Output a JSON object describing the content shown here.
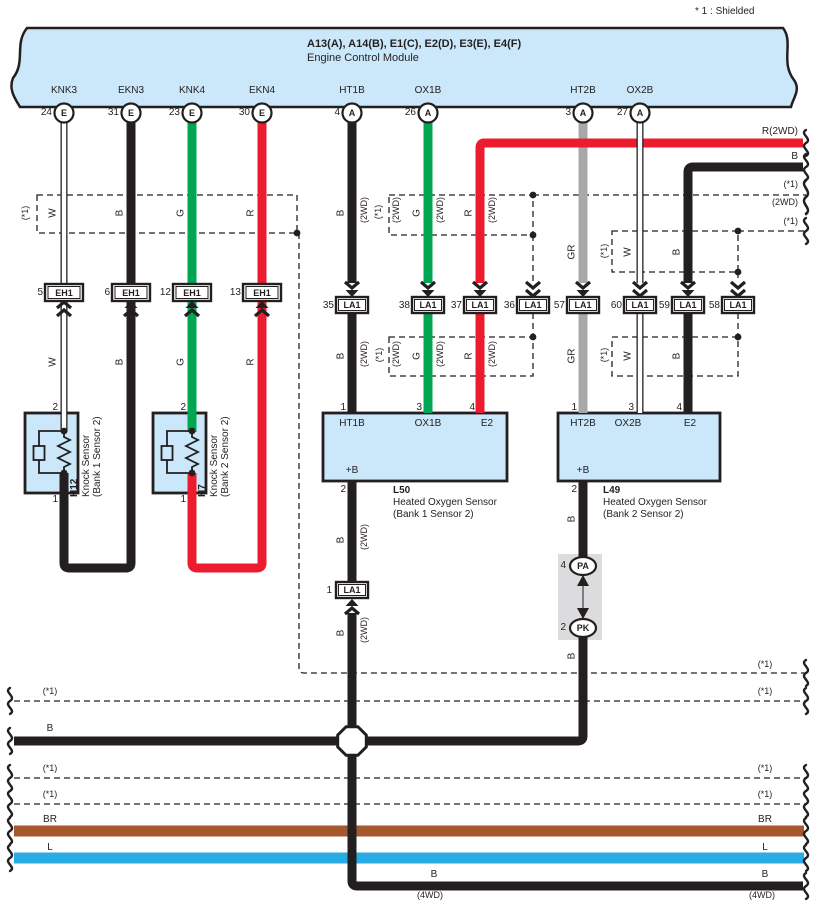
{
  "note": "* 1 : Shielded",
  "labels": {
    "w": "W",
    "b": "B",
    "g": "G",
    "r": "R",
    "gr": "GR",
    "br": "BR",
    "l": "L",
    "shield": "(*1)",
    "wd2": "(2WD)",
    "wd4": "(4WD)",
    "r2wd": "R(2WD)"
  },
  "ecm": {
    "title": "A13(A), A14(B), E1(C), E2(D), E3(E), E4(F)",
    "subtitle": "Engine Control Module",
    "terminals": [
      {
        "name": "KNK3",
        "pin": "24",
        "code": "E"
      },
      {
        "name": "EKN3",
        "pin": "31",
        "code": "E"
      },
      {
        "name": "KNK4",
        "pin": "23",
        "code": "E"
      },
      {
        "name": "EKN4",
        "pin": "30",
        "code": "E"
      },
      {
        "name": "HT1B",
        "pin": "4",
        "code": "A"
      },
      {
        "name": "OX1B",
        "pin": "26",
        "code": "A"
      },
      {
        "name": "HT2B",
        "pin": "3",
        "code": "A"
      },
      {
        "name": "OX2B",
        "pin": "27",
        "code": "A"
      }
    ]
  },
  "connectors": {
    "eh1": {
      "label": "EH1",
      "pins": [
        "5",
        "6",
        "12",
        "13"
      ]
    },
    "la1_row": {
      "label": "LA1",
      "pins": [
        "35",
        "38",
        "37",
        "36",
        "57",
        "60",
        "59",
        "58"
      ]
    },
    "la1_b": {
      "label": "LA1",
      "pin": "1"
    },
    "pa": {
      "label": "PA",
      "pin": "4"
    },
    "pk": {
      "label": "PK",
      "pin": "2"
    }
  },
  "components": {
    "h12": {
      "id": "H12",
      "name": "Knock Sensor",
      "bank": "(Bank 1 Sensor 2)",
      "pin_top": "2",
      "pin_bottom": "1"
    },
    "h7": {
      "id": "H7",
      "name": "Knock Sensor",
      "bank": "(Bank 2 Sensor 2)",
      "pin_top": "2",
      "pin_bottom": "1"
    },
    "l50": {
      "id": "L50",
      "name": "Heated Oxygen Sensor",
      "bank": "(Bank 1 Sensor 2)",
      "terminals": {
        "ht": "HT1B",
        "ox": "OX1B",
        "e2": "E2",
        "plus_b": "+B"
      },
      "pins": {
        "ht": "1",
        "ox": "3",
        "e2": "4",
        "plus_b": "2"
      }
    },
    "l49": {
      "id": "L49",
      "name": "Heated Oxygen Sensor",
      "bank": "(Bank 2 Sensor 2)",
      "terminals": {
        "ht": "HT2B",
        "ox": "OX2B",
        "e2": "E2",
        "plus_b": "+B"
      },
      "pins": {
        "ht": "1",
        "ox": "3",
        "e2": "4",
        "plus_b": "2"
      }
    }
  },
  "palette": {
    "black": "#231f20",
    "green": "#00a651",
    "red": "#ec1c2e",
    "gray": "#a8a8ab",
    "brown": "#a5572e",
    "blue": "#29abe3",
    "ecm_fill": "#cbe7fa",
    "panel_gray": "#dcdcde"
  }
}
